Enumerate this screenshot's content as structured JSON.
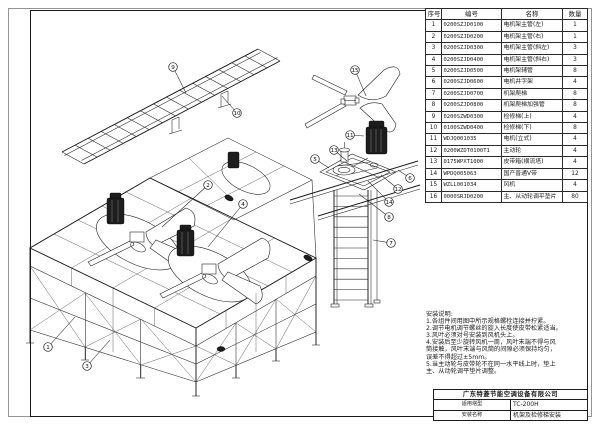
{
  "parts_table": {
    "headers": [
      "序号",
      "编号",
      "名称",
      "数量"
    ],
    "rows": [
      [
        "1",
        "0200SZJD0100",
        "电机架主管(左)",
        "1"
      ],
      [
        "2",
        "0200SZJD0200",
        "电机架主管(右)",
        "1"
      ],
      [
        "3",
        "0200SZJD0300",
        "电机架主管(斜左)",
        "3"
      ],
      [
        "4",
        "0200SZJD0400",
        "电机架主管(斜右)",
        "3"
      ],
      [
        "5",
        "0200SZJD0500",
        "电机架辅管",
        "8"
      ],
      [
        "6",
        "0200SZJD0600",
        "电机井字架",
        "4"
      ],
      [
        "7",
        "0200SZJD0700",
        "机架爬梯",
        "8"
      ],
      [
        "8",
        "0200SZJD0800",
        "机架爬梯加强管",
        "8"
      ],
      [
        "9",
        "0200SZWD0300",
        "检修梯(上)",
        "4"
      ],
      [
        "10",
        "0100SZWD0400",
        "检修梯(下)",
        "8"
      ],
      [
        "11",
        "WDJQ001035",
        "电机(立式)",
        "4"
      ],
      [
        "12",
        "0200WZDT0100T1",
        "主动轮",
        "4"
      ],
      [
        "13",
        "0175WPXT1000",
        "皮带箱(横流塔)",
        "4"
      ],
      [
        "14",
        "WPDQ005063",
        "国产普通V带",
        "12"
      ],
      [
        "15",
        "WZLL001034",
        "风机",
        "4"
      ],
      [
        "16",
        "0000SRJD0200",
        "主、从动轮调平垫片",
        "80"
      ]
    ]
  },
  "install_notes": {
    "title": "安装说明:",
    "lines": [
      "1.各组件间用图中所示规格螺栓连接并拧紧。",
      "2.调节电机调节螺丝的旋入长度使皮带松紧适当。",
      "3.风叶必须对号安装到风机头上。",
      "4.安装后至少旋转风机一周，风叶末端不得与风",
      "筒接触，风叶末端与风筒的间隙必须保持均匀，",
      "误差不得超过±5mm。",
      "5.当主动轮与皮带轮不在同一水平线上时，垫上",
      "主、从动轮调平垫片调整。"
    ]
  },
  "title_block": {
    "company": "广东特菱节能空调设备有限公司",
    "model_label": "适用塔型",
    "model_value": "TC-200H",
    "name_label": "安装名称",
    "name_value": "机架及检修梯安装"
  },
  "callouts": [
    "9",
    "10",
    "15",
    "11",
    "13",
    "5",
    "6",
    "12",
    "14",
    "8",
    "7",
    "2",
    "4",
    "1",
    "3"
  ]
}
